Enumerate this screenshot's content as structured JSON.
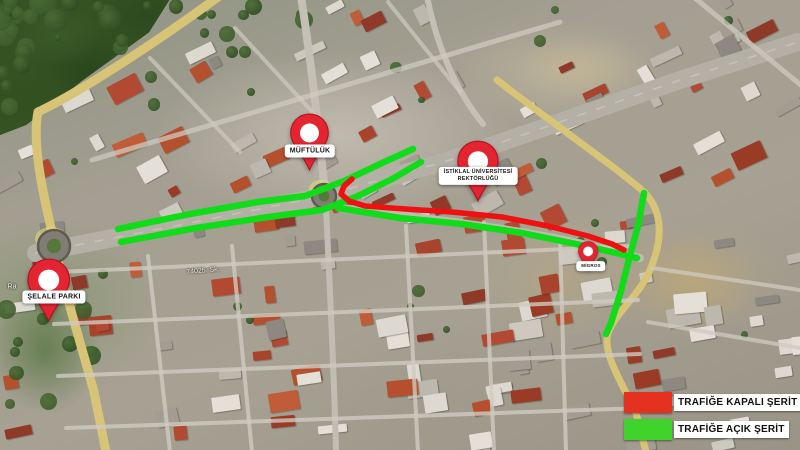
{
  "map": {
    "street_labels": [
      {
        "text": "74025. Sk.",
        "x": 203,
        "y": 271,
        "angle": -5
      },
      {
        "text": "Ra",
        "x": 12,
        "y": 287,
        "angle": 0
      }
    ],
    "roundabouts": [
      {
        "x": 54,
        "y": 246,
        "r": 16
      },
      {
        "x": 324,
        "y": 196,
        "r": 12
      }
    ]
  },
  "pins": [
    {
      "id": "muftuluk",
      "label_lines": [
        "MÜFTÜLÜK"
      ],
      "x": 309,
      "tip_y": 171,
      "height": 58,
      "label_x": 310,
      "label_y": 151,
      "font": 7
    },
    {
      "id": "istiklal-universitesi-rektorlugu",
      "label_lines": [
        "İSTİKLAL ÜNİVERSİTESİ",
        "REKTÖRLÜĞÜ"
      ],
      "x": 478,
      "tip_y": 202,
      "height": 62,
      "label_x": 478,
      "label_y": 176,
      "font": 5.5
    },
    {
      "id": "migros",
      "label_lines": [
        "MİGROS"
      ],
      "x": 588,
      "tip_y": 271,
      "height": 30,
      "label_x": 591,
      "label_y": 266,
      "font": 4.5
    },
    {
      "id": "selale-parki",
      "label_lines": [
        "ŞELALE PARKI"
      ],
      "x": 49,
      "tip_y": 322,
      "height": 64,
      "label_x": 54,
      "label_y": 297,
      "font": 7
    }
  ],
  "routes": {
    "open_color": "#10dc1a",
    "closed_color": "#ed1111",
    "lines": [
      {
        "type": "open",
        "points": [
          [
            118,
            229
          ],
          [
            190,
            214
          ],
          [
            258,
            202
          ],
          [
            305,
            196
          ],
          [
            344,
            181
          ],
          [
            382,
            163
          ],
          [
            413,
            149
          ]
        ]
      },
      {
        "type": "open",
        "points": [
          [
            121,
            242
          ],
          [
            196,
            228
          ],
          [
            268,
            217
          ],
          [
            322,
            210
          ],
          [
            358,
            196
          ],
          [
            394,
            178
          ],
          [
            421,
            162
          ]
        ]
      },
      {
        "type": "open",
        "points": [
          [
            338,
            208
          ],
          [
            400,
            218
          ],
          [
            462,
            224
          ],
          [
            522,
            233
          ],
          [
            576,
            244
          ],
          [
            612,
            252
          ],
          [
            637,
            258
          ]
        ]
      },
      {
        "type": "open",
        "points": [
          [
            644,
            193
          ],
          [
            638,
            226
          ],
          [
            629,
            259
          ],
          [
            621,
            291
          ],
          [
            611,
            323
          ],
          [
            606,
            334
          ]
        ]
      },
      {
        "type": "closed",
        "points": [
          [
            352,
            179
          ],
          [
            344,
            186
          ],
          [
            341,
            194
          ],
          [
            349,
            201
          ],
          [
            365,
            206
          ],
          [
            405,
            209
          ],
          [
            452,
            212
          ],
          [
            502,
            217
          ],
          [
            548,
            226
          ],
          [
            588,
            236
          ],
          [
            612,
            244
          ],
          [
            624,
            250
          ]
        ]
      }
    ]
  },
  "legend": {
    "items": [
      {
        "id": "closed-lane",
        "label": "TRAFİĞE KAPALI ŞERİT",
        "color": "#e5311f"
      },
      {
        "id": "open-lane",
        "label": "TRAFİĞE AÇIK ŞERİT",
        "color": "#40d32b"
      }
    ]
  }
}
